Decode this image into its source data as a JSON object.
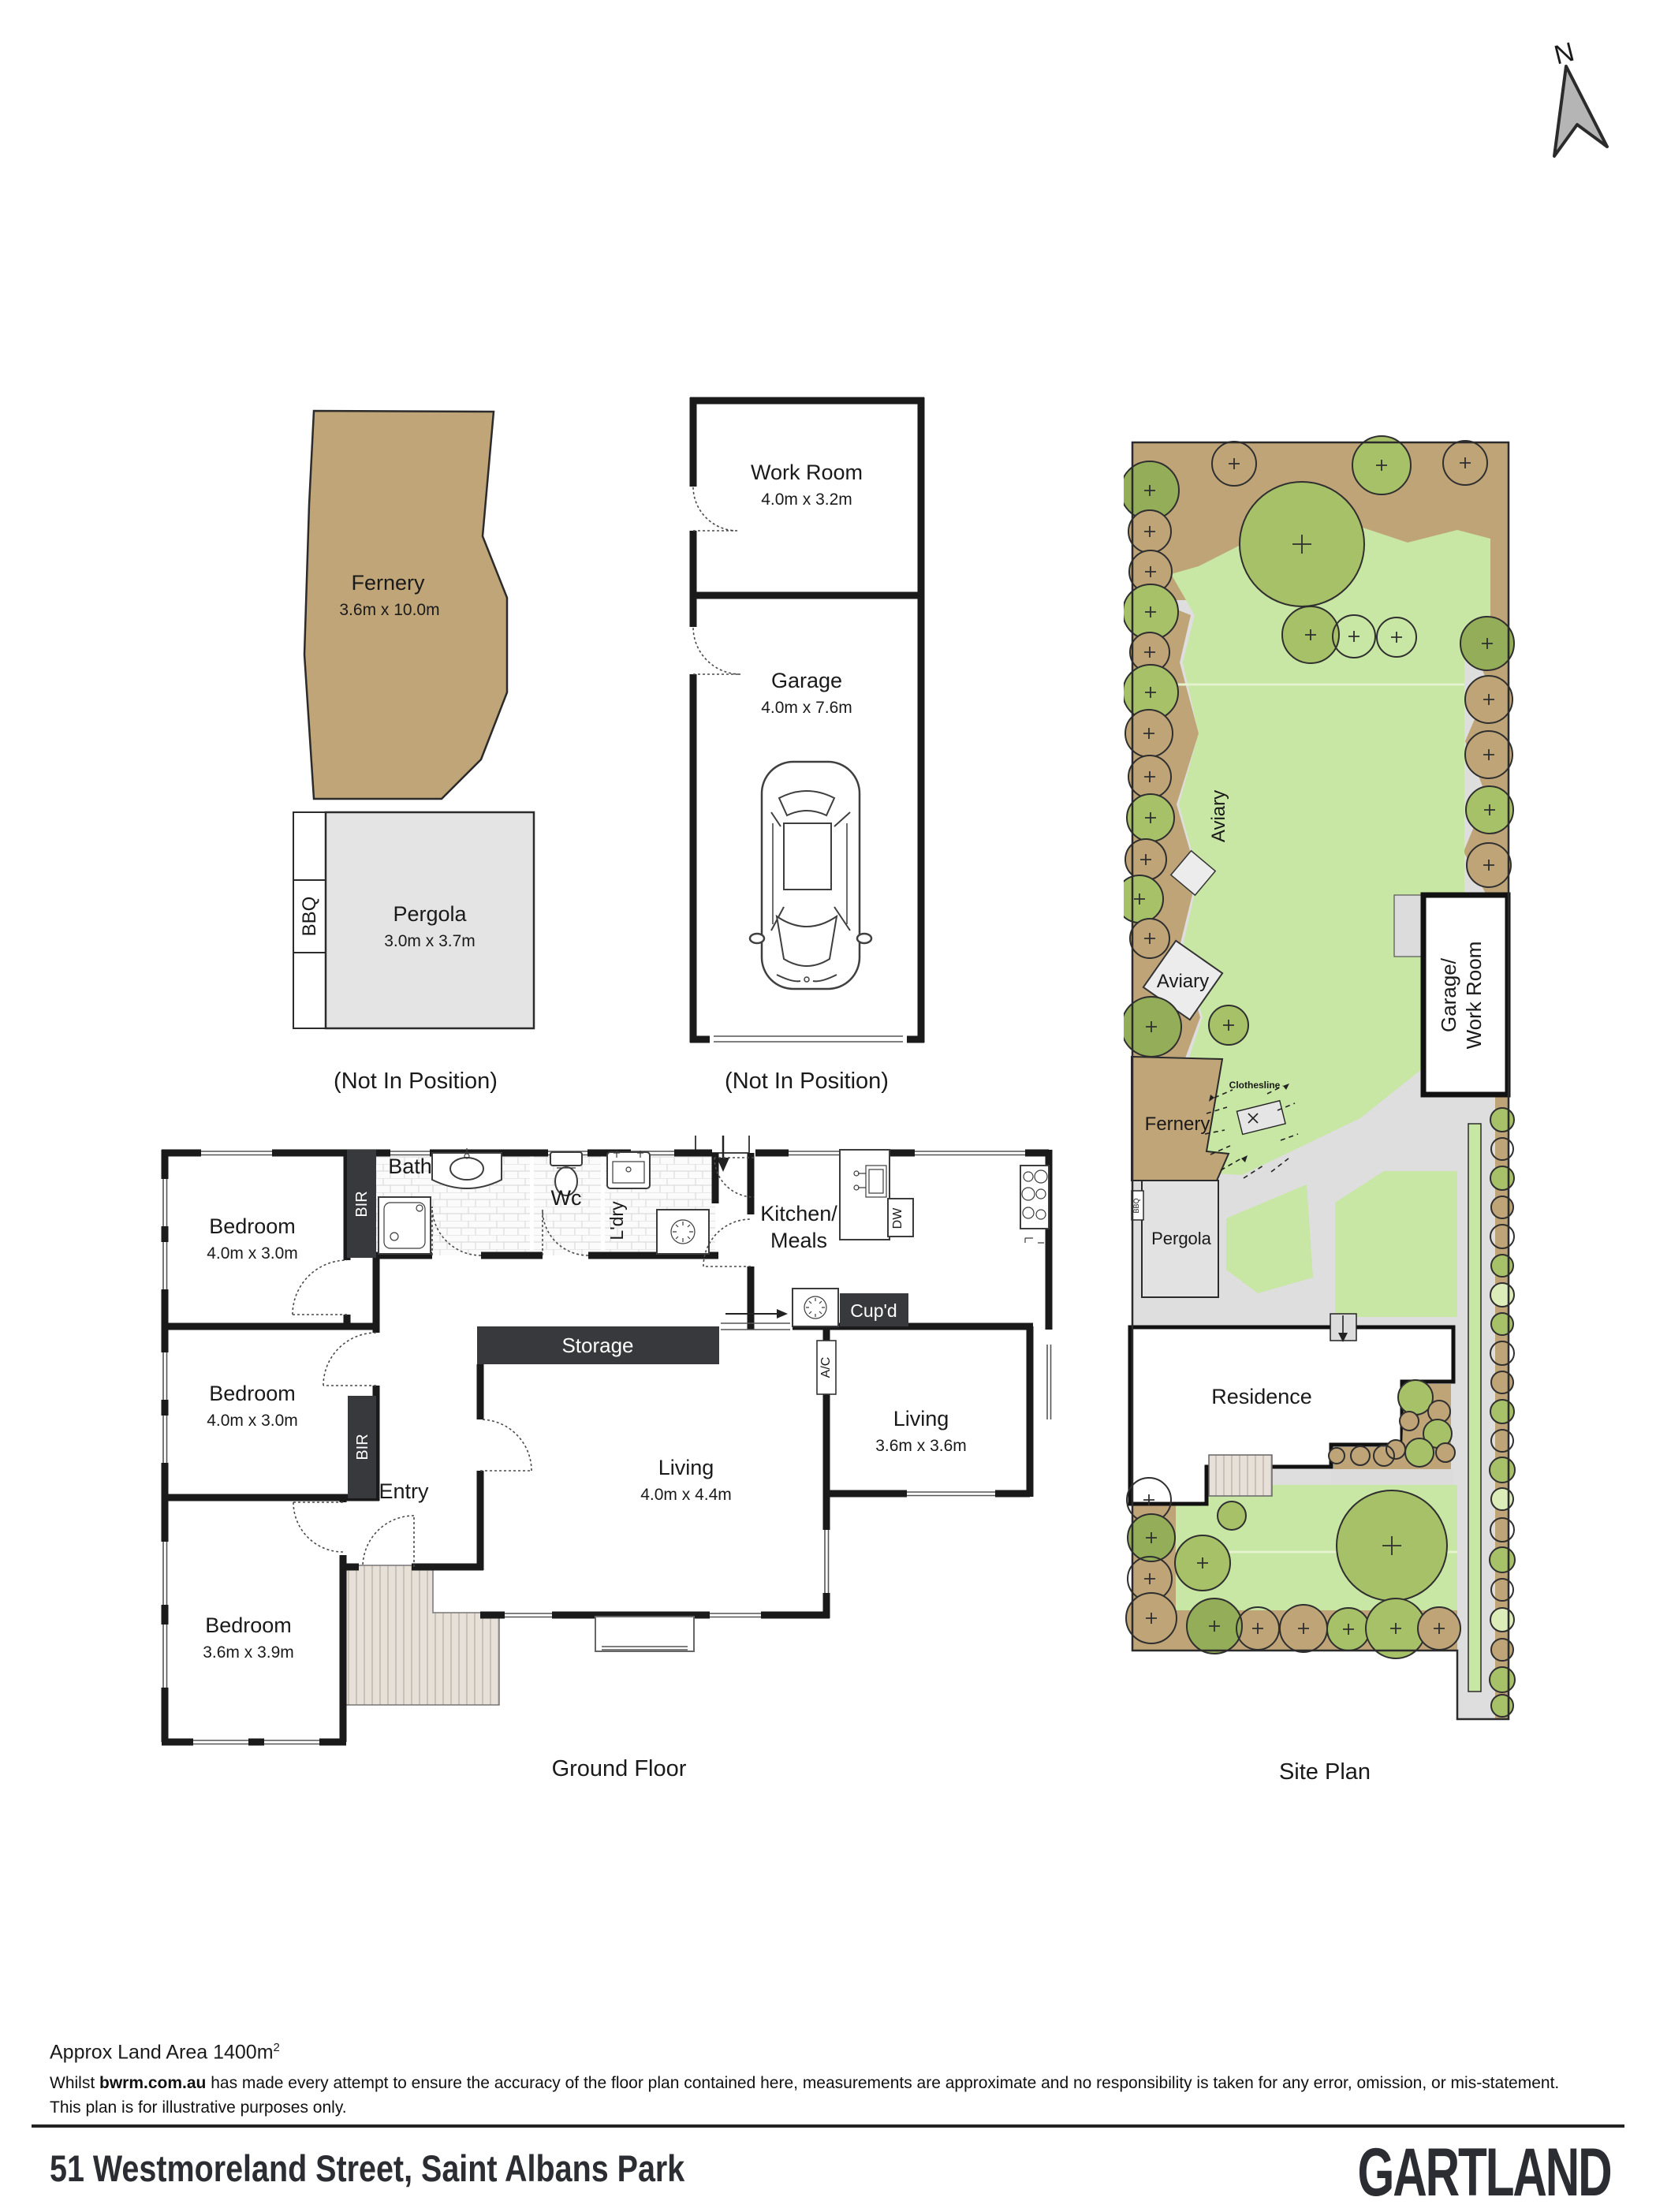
{
  "colors": {
    "wall": "#1a1a1a",
    "dark_block": "#37393c",
    "fernery_brown": "#c0a578",
    "pergola_grey": "#e4e4e4",
    "lawn_green": "#c8e6a4",
    "garden_bed_brown": "#bfa478",
    "tree_olive": "#a7c168",
    "path_grey": "#dedede",
    "logo_ink": "#2b2d33"
  },
  "north": {
    "label": "N"
  },
  "outbuildings": {
    "fernery": {
      "name": "Fernery",
      "dims": "3.6m x 10.0m"
    },
    "bbq": "BBQ",
    "pergola": {
      "name": "Pergola",
      "dims": "3.0m x 3.7m"
    },
    "caption": "(Not In Position)"
  },
  "garage_block": {
    "work_room": {
      "name": "Work Room",
      "dims": "4.0m x 3.2m"
    },
    "garage": {
      "name": "Garage",
      "dims": "4.0m x 7.6m"
    },
    "caption": "(Not In Position)"
  },
  "ground_floor": {
    "caption": "Ground Floor",
    "rooms": {
      "bedroom1": {
        "name": "Bedroom",
        "dims": "4.0m x 3.0m"
      },
      "bedroom2": {
        "name": "Bedroom",
        "dims": "4.0m x 3.0m"
      },
      "bedroom3": {
        "name": "Bedroom",
        "dims": "3.6m x 3.9m"
      },
      "bath": "Bath",
      "wc": "Wc",
      "ldry": "L'dry",
      "kitchen_line1": "Kitchen/",
      "kitchen_line2": "Meals",
      "living1": {
        "name": "Living",
        "dims": "4.0m x 4.4m"
      },
      "living2": {
        "name": "Living",
        "dims": "3.6m x 3.6m"
      },
      "storage": "Storage",
      "cupd": "Cup'd",
      "entry": "Entry",
      "bir": "BIR",
      "ac": "A/C",
      "dw": "DW"
    }
  },
  "site_plan": {
    "caption": "Site Plan",
    "labels": {
      "aviary_side": "Aviary",
      "aviary": "Aviary",
      "clothesline": "Clothesline",
      "fernery": "Fernery",
      "pergola": "Pergola",
      "bbq": "BBQ",
      "residence": "Residence",
      "garage_line1": "Garage/",
      "garage_line2": "Work Room"
    }
  },
  "footer": {
    "land_area_text": "Approx Land Area 1400m",
    "land_area_sup": "2",
    "disclaimer_prefix": "Whilst ",
    "disclaimer_bold": "bwrm.com.au",
    "disclaimer_rest": " has made every attempt to ensure the accuracy of the floor plan contained here, measurements are approximate and no responsibility is taken for any error, omission, or mis-statement.",
    "disclaimer_line2": "This plan is for illustrative purposes only.",
    "address": "51 Westmoreland Street, Saint Albans Park",
    "brand": "GARTLAND"
  }
}
